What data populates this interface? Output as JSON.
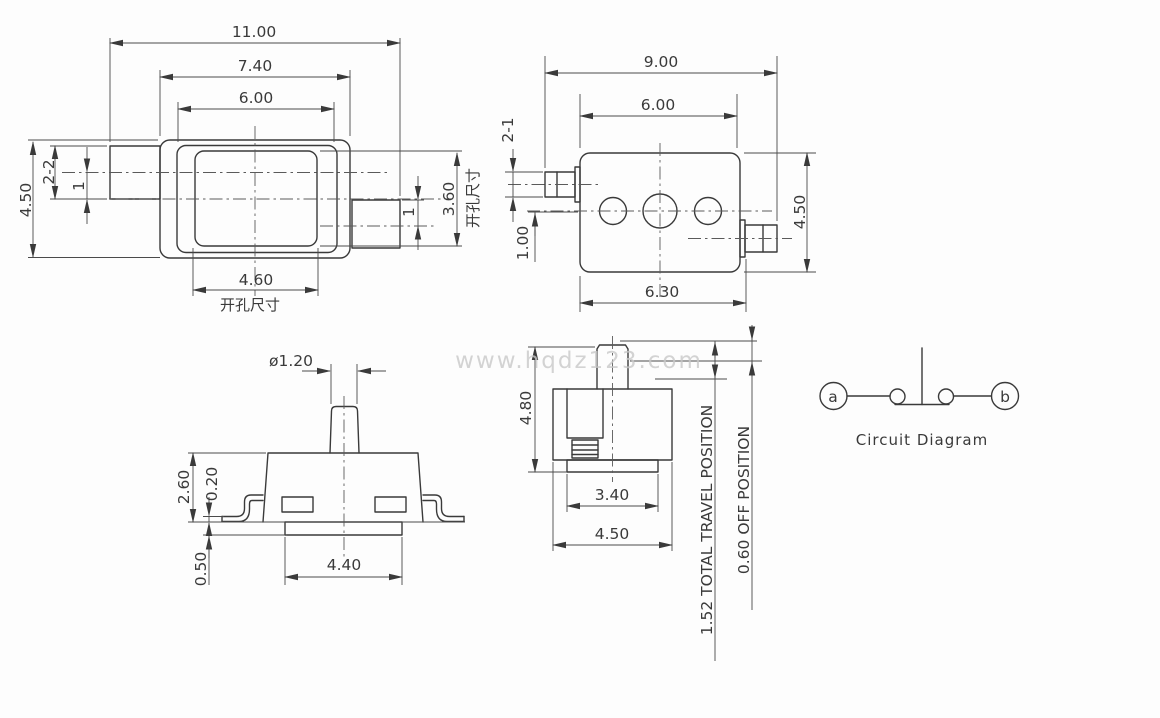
{
  "watermark": "www.hqdz123.com",
  "plan_view": {
    "dim_overall_width": "11.00",
    "dim_flange_width": "7.40",
    "dim_body_width": "6.00",
    "dim_body_height": "4.50",
    "dim_tab_spec_left": "2-2",
    "dim_tab_half_left": "1",
    "dim_cutout_height": "3.60",
    "cutout_label_right": "开孔尺寸",
    "dim_tab_half_right": "1",
    "dim_cutout_width": "4.60",
    "cutout_label_bottom": "开孔尺寸"
  },
  "bottom_view": {
    "dim_overall_width": "9.00",
    "dim_body_width": "6.00",
    "dim_tab_spec": "2-1",
    "dim_tab_offset": "1.00",
    "dim_body_height": "4.50",
    "dim_base_width": "6.30"
  },
  "front_view": {
    "dim_stem_diameter": "ø1.20",
    "dim_body_height": "2.60",
    "dim_lead_thickness": "0.20",
    "dim_base_height": "0.50",
    "dim_base_width": "4.40"
  },
  "side_view": {
    "dim_total_height": "4.80",
    "dim_plate_width": "3.40",
    "dim_body_width": "4.50",
    "dim_travel": "1.52  TOTAL  TRAVEL  POSITION",
    "dim_off_position": "0.60  OFF  POSITION"
  },
  "circuit": {
    "terminal_a": "a",
    "terminal_b": "b",
    "caption": "Circuit  Diagram"
  }
}
